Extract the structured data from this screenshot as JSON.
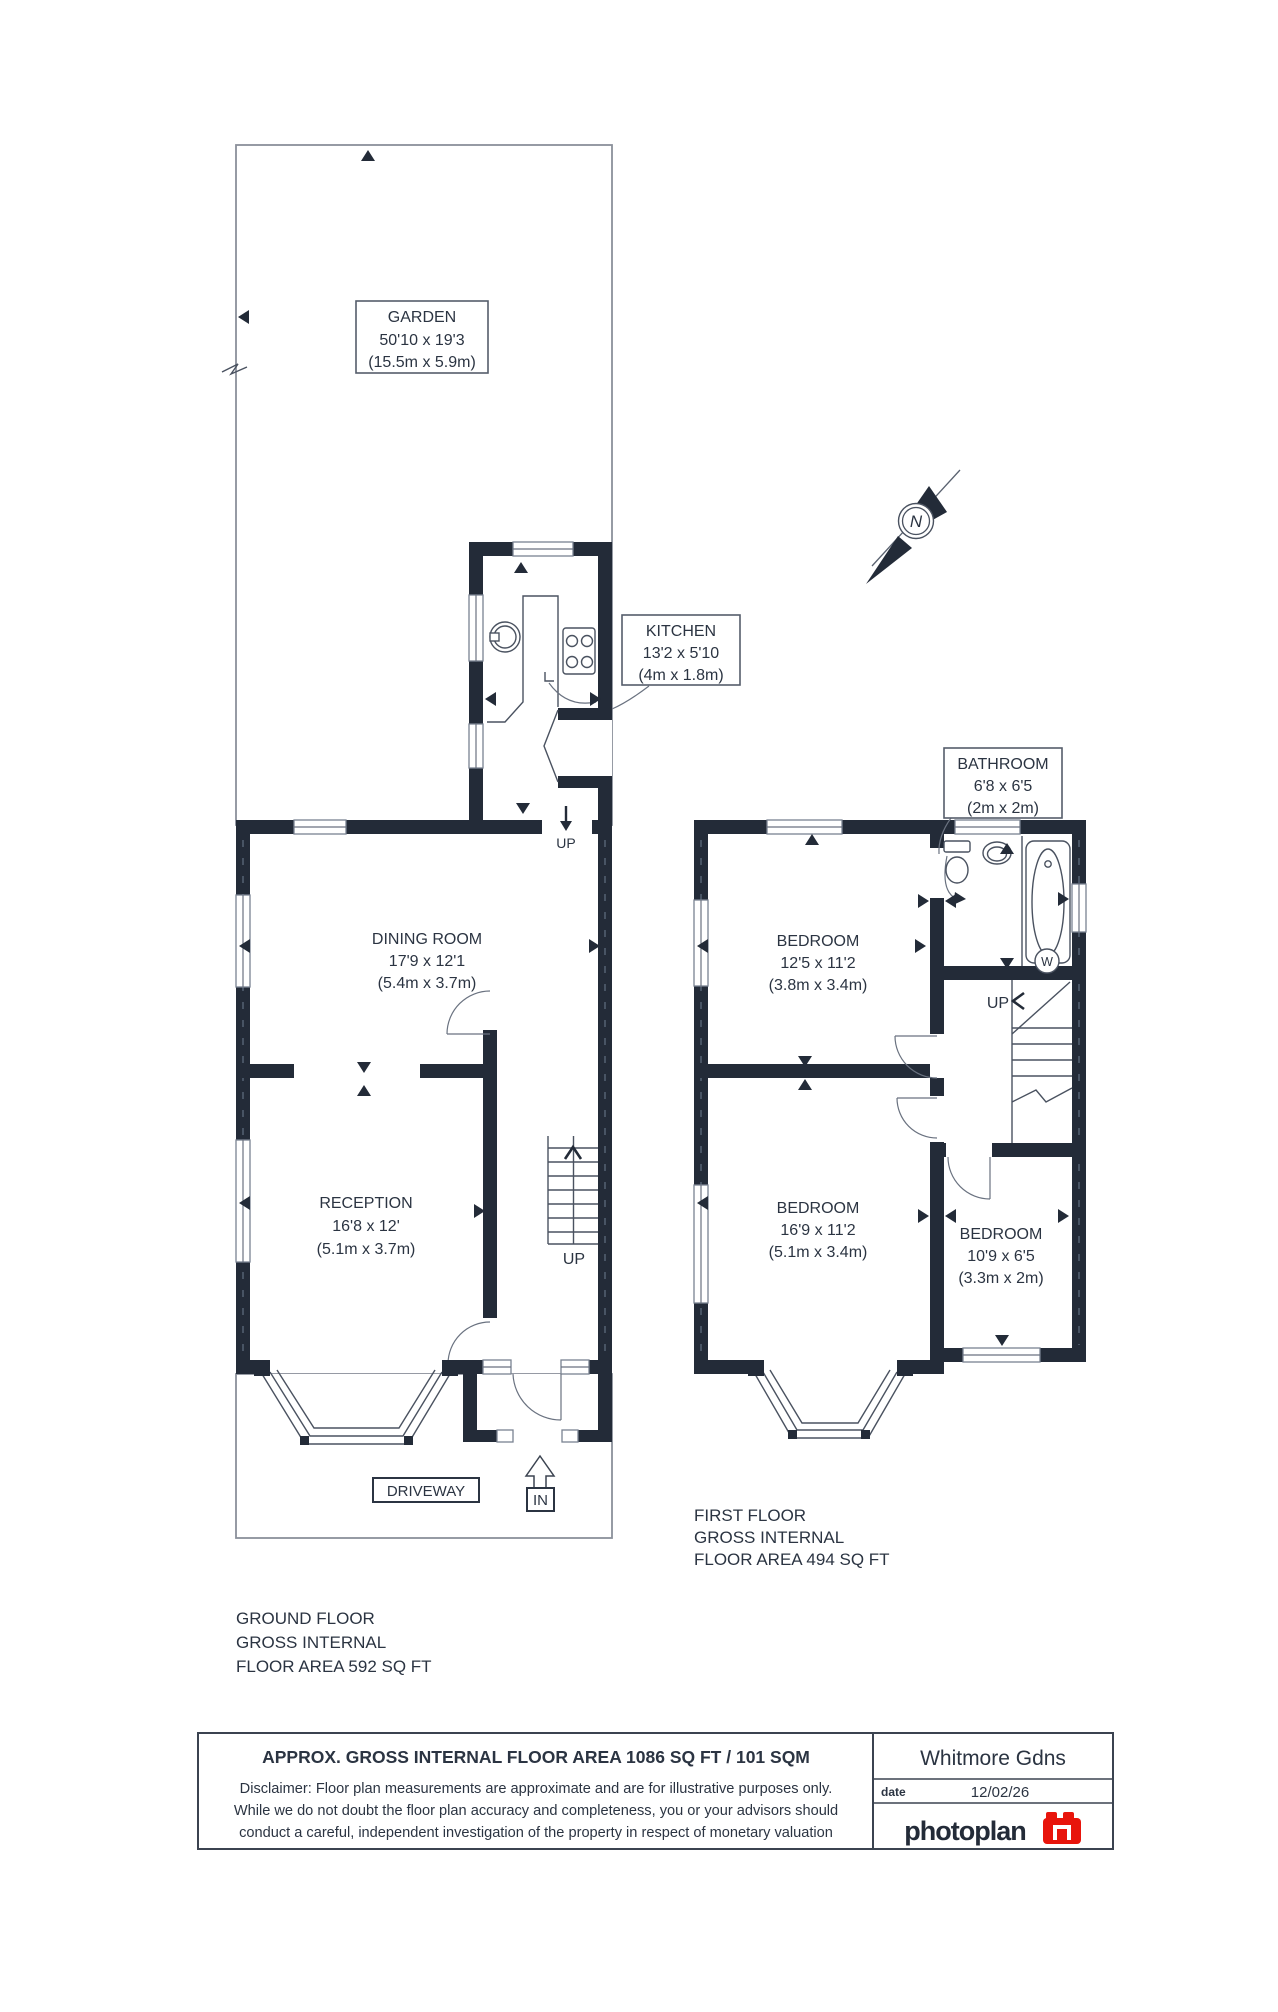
{
  "compass": {
    "north_label": "N"
  },
  "symbols": {
    "water_label": "W",
    "in_label": "IN"
  },
  "ground_floor": {
    "summary": [
      "GROUND FLOOR",
      "GROSS INTERNAL",
      "FLOOR AREA 592 SQ FT"
    ],
    "up_label_kitchen": "UP",
    "up_label_stairs": "UP",
    "rooms": {
      "garden": {
        "name": "GARDEN",
        "imperial": "50'10 x 19'3",
        "metric": "(15.5m x 5.9m)"
      },
      "kitchen": {
        "name": "KITCHEN",
        "imperial": "13'2 x 5'10",
        "metric": "(4m x 1.8m)"
      },
      "dining": {
        "name": "DINING ROOM",
        "imperial": "17'9 x 12'1",
        "metric": "(5.4m x 3.7m)"
      },
      "reception": {
        "name": "RECEPTION",
        "imperial": "16'8 x 12'",
        "metric": "(5.1m x 3.7m)"
      },
      "driveway": {
        "name": "DRIVEWAY"
      }
    }
  },
  "first_floor": {
    "summary": [
      "FIRST FLOOR",
      "GROSS INTERNAL",
      "FLOOR AREA 494 SQ FT"
    ],
    "up_label_stairs": "UP",
    "rooms": {
      "bathroom": {
        "name": "BATHROOM",
        "imperial": "6'8 x 6'5",
        "metric": "(2m x 2m)"
      },
      "bedroom1": {
        "name": "BEDROOM",
        "imperial": "12'5 x 11'2",
        "metric": "(3.8m x 3.4m)"
      },
      "bedroom2": {
        "name": "BEDROOM",
        "imperial": "16'9 x 11'2",
        "metric": "(5.1m x 3.4m)"
      },
      "bedroom3": {
        "name": "BEDROOM",
        "imperial": "10'9 x 6'5",
        "metric": "(3.3m x 2m)"
      }
    }
  },
  "title_block": {
    "approx_area": "APPROX. GROSS INTERNAL FLOOR AREA 1086 SQ FT / 101 SQM",
    "disclaimer_line1": "Disclaimer: Floor plan measurements are approximate and are for illustrative purposes only.",
    "disclaimer_line2": "While we do not doubt the floor plan accuracy and completeness, you or your advisors should",
    "disclaimer_line3": "conduct a careful, independent investigation of the property in respect of monetary valuation",
    "property_name": "Whitmore Gdns",
    "date_label": "date",
    "date_value": "12/02/26",
    "logo_text": "photoplan"
  },
  "colors": {
    "wall": "#232b38",
    "accent_red": "#e8150c",
    "text": "#2b3442"
  }
}
